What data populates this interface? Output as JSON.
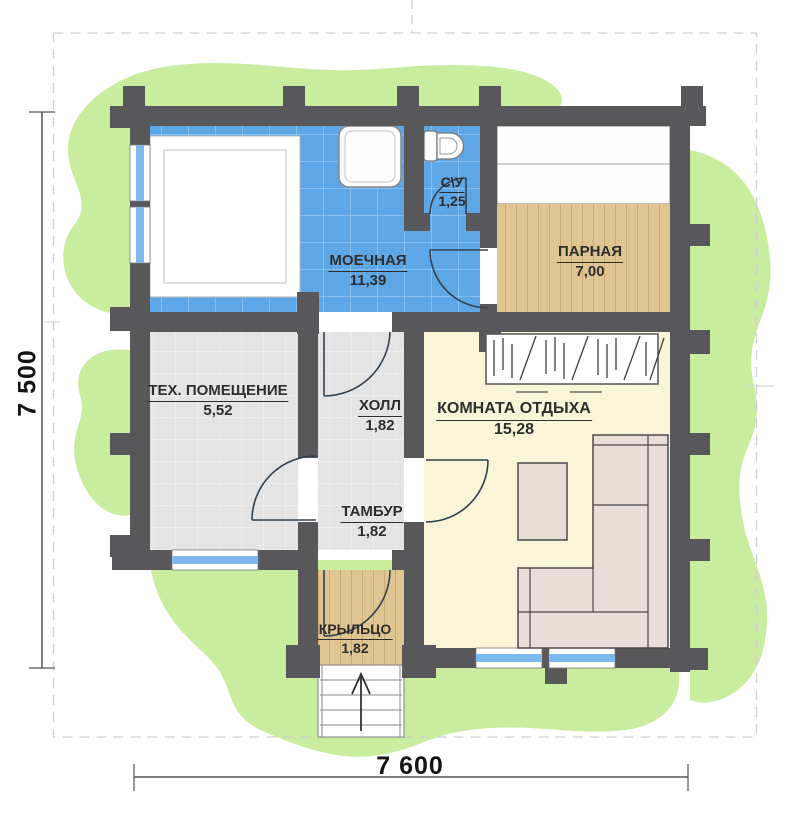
{
  "plan": {
    "title": "sauna-floor-plan",
    "rooms": [
      {
        "id": "washing",
        "name": "МОЕЧНАЯ",
        "area": "11,39"
      },
      {
        "id": "wc",
        "name": "С\\У",
        "area": "1,25"
      },
      {
        "id": "steam",
        "name": "ПАРНАЯ",
        "area": "7,00"
      },
      {
        "id": "tech",
        "name": "ТЕХ. ПОМЕЩЕНИЕ",
        "area": "5,52"
      },
      {
        "id": "hall",
        "name": "ХОЛЛ",
        "area": "1,82"
      },
      {
        "id": "rest",
        "name": "КОМНАТА ОТДЫХА",
        "area": "15,28"
      },
      {
        "id": "tambour",
        "name": "ТАМБУР",
        "area": "1,82"
      },
      {
        "id": "porch",
        "name": "КРЫЛЬЦО",
        "area": "1,82"
      }
    ],
    "dimensions": {
      "width_label": "7 600",
      "height_label": "7 500"
    },
    "fixtures": [
      "pool",
      "shower",
      "toilet",
      "steam-bench",
      "hatched-bench",
      "corner-sofa",
      "coffee-table",
      "entrance-stairs"
    ],
    "colors": {
      "wall": "#58585b",
      "tile_floor": "#5ea7e7",
      "tile_line": "#9bcdf6",
      "wood_floor": "#dfc592",
      "wood_line": "#cbab73",
      "gray_floor": "#e4e4e4",
      "cream_floor": "#faf5d8",
      "greenery": "#c9ed9e",
      "window_glass": "#7db9ed",
      "furniture": "#e9ddd7"
    }
  }
}
